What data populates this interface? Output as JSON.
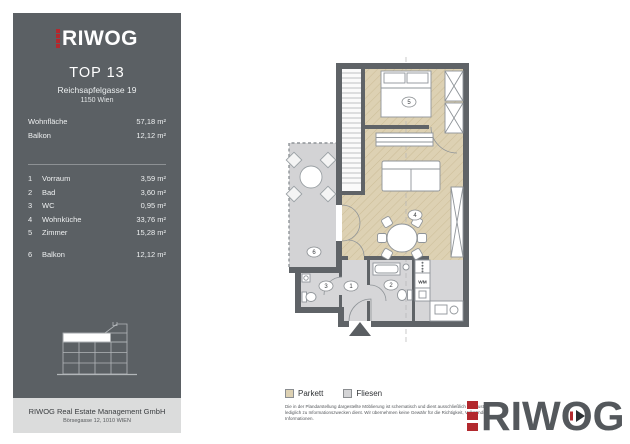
{
  "brand": {
    "name": "RIWOG",
    "red": "#b2292e",
    "company_name": "RIWOG Real Estate Management GmbH",
    "company_address": "Börsegasse 12, 1010 WIEN"
  },
  "sidebar": {
    "title": "TOP 13",
    "address_line1": "Reichsapfelgasse 19",
    "address_line2": "1150 Wien",
    "metrics": [
      {
        "label": "Wohnfläche",
        "value": "57,18 m²"
      },
      {
        "label": "Balkon",
        "value": "12,12 m²"
      }
    ],
    "rooms": [
      {
        "no": "1",
        "name": "Vorraum",
        "area": "3,59 m²"
      },
      {
        "no": "2",
        "name": "Bad",
        "area": "3,60 m²"
      },
      {
        "no": "3",
        "name": "WC",
        "area": "0,95 m²"
      },
      {
        "no": "4",
        "name": "Wohnküche",
        "area": "33,76 m²"
      },
      {
        "no": "5",
        "name": "Zimmer",
        "area": "15,28 m²"
      },
      {
        "no": "6",
        "name": "Balkon",
        "area": "12,12 m²"
      }
    ]
  },
  "plan": {
    "wm_label": "WM",
    "colors": {
      "parkett": "#ddd1b3",
      "fliesen": "#d6d6d8",
      "balcony": "#d3d3d5",
      "wall": "#5f6367"
    }
  },
  "legend": {
    "items": [
      {
        "label": "Parkett",
        "color": "#ddd1b3"
      },
      {
        "label": "Fliesen",
        "color": "#d4d4d6"
      }
    ]
  },
  "disclaimer": {
    "line1": "Die in der Plandarstellung dargestellte Möblierung ist schematisch und dient ausschließlich zur Illustration,",
    "line2": "lediglich zu Informationszwecken dient. Wir übernehmen keine Gewähr für die Richtigkeit, Vollständigkeit der",
    "line3": "Informationen."
  }
}
